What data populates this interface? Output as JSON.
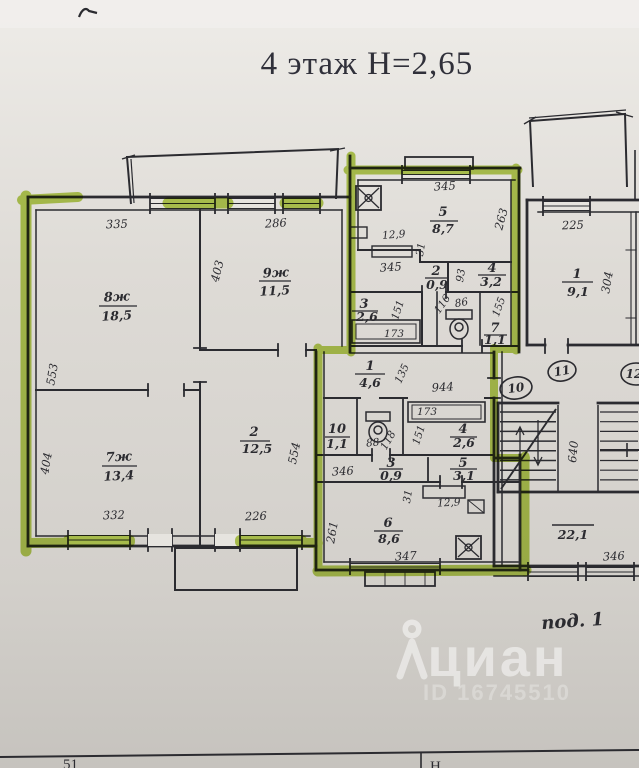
{
  "title": "4 этаж Н=2,65",
  "entrance_label": "под. 1",
  "watermark": {
    "brand": "циан",
    "id": "ID 16745510"
  },
  "apartment_numbers": {
    "a10": "10",
    "a11": "11",
    "a12": "12"
  },
  "common": {
    "area": "22,1"
  },
  "rooms": {
    "r8": {
      "num": "8ж",
      "area": "18,5"
    },
    "r9": {
      "num": "9ж",
      "area": "11,5"
    },
    "r7": {
      "num": "7ж",
      "area": "13,4"
    },
    "r2": {
      "num": "2",
      "area": "12,5"
    },
    "k5": {
      "num": "5",
      "area": "8,7"
    },
    "c2": {
      "num": "2",
      "area": "0,9"
    },
    "c4": {
      "num": "4",
      "area": "3,2"
    },
    "c3": {
      "num": "3",
      "area": "2,6"
    },
    "c7": {
      "num": "7",
      "area": "1,1"
    },
    "r1": {
      "num": "1",
      "area": "9,1"
    },
    "h1": {
      "num": "1",
      "area": "4,6"
    },
    "h10": {
      "num": "10",
      "area": "1,1"
    },
    "h4": {
      "num": "4",
      "area": "2,6"
    },
    "h3": {
      "num": "3",
      "area": "0,9"
    },
    "h5": {
      "num": "5",
      "area": "3,1"
    },
    "k6": {
      "num": "6",
      "area": "8,6"
    }
  },
  "dims": {
    "d335": "335",
    "d553": "553",
    "d286": "286",
    "d403": "403",
    "d404": "404",
    "d332": "332",
    "d226": "226",
    "d554": "554",
    "d345a": "345",
    "d263": "263",
    "d129a": "12,9",
    "d31a": "31",
    "d345b": "345",
    "d93": "93",
    "d151a": "151",
    "d173a": "173",
    "d116": "116",
    "d86": "86",
    "d155": "155",
    "d225": "225",
    "d304": "304",
    "d135": "135",
    "d944": "944",
    "d88": "88",
    "d118": "118",
    "d173b": "173",
    "d151b": "151",
    "d346a": "346",
    "d31b": "31",
    "d129b": "12,9",
    "d261": "261",
    "d347": "347",
    "d640": "640",
    "d346b": "346"
  },
  "footer": {
    "page": "51",
    "col": "Н"
  },
  "colors": {
    "marker_green": "#aecb3e",
    "ink": "#2b2b30",
    "paper_top": "#eceae6",
    "paper_bottom": "#c7c4bf"
  }
}
